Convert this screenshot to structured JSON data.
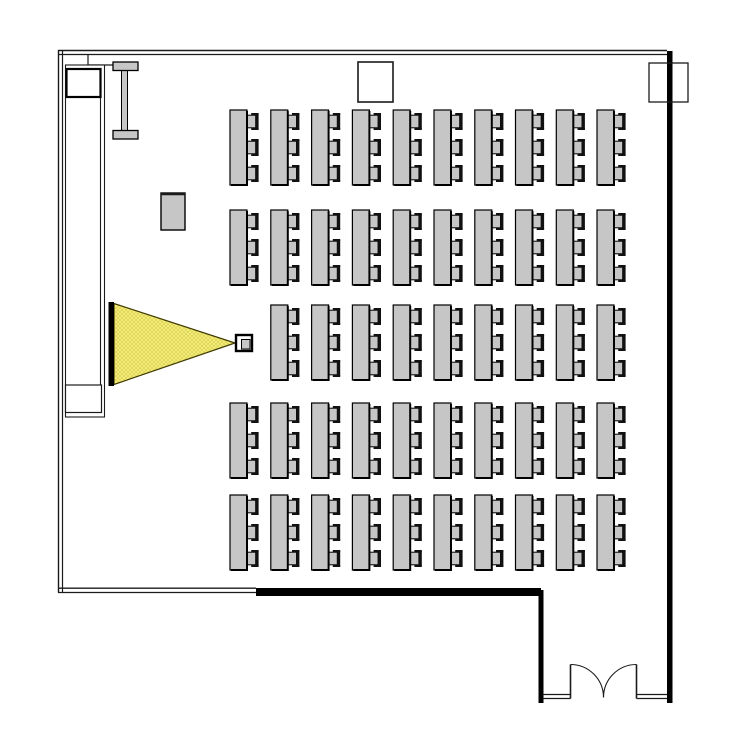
{
  "plan": {
    "canvas": {
      "width": 750,
      "height": 750,
      "background": "#ffffff"
    },
    "colors": {
      "line": "#1b1b1b",
      "wall_thick": "#000000",
      "furniture_fill": "#c6c6c6",
      "furniture_stroke": "#000000",
      "chair_dark": "#111111",
      "white": "#ffffff",
      "beam_fill": "#f8f480",
      "beam_hatch": "#ddd257",
      "beam_stroke": "#3f3a00",
      "screen_fill": "#000000"
    },
    "walls": {
      "top": {
        "y_outer": 50.5,
        "y_inner": 54.5,
        "x_start": 58,
        "x_end": 667
      },
      "top_notch": {
        "points": [
          [
            88,
            54.5
          ],
          [
            88,
            65
          ],
          [
            113,
            65
          ]
        ]
      },
      "left": {
        "x_outer": 58.5,
        "x_inner": 62.5,
        "y_start": 50,
        "y_end": 592.5
      },
      "bottom_thin": {
        "y_outer": 588.2,
        "y_inner": 592.5,
        "x_start": 58,
        "x_end": 256
      },
      "bottom_thick": {
        "x": 256,
        "y": 588,
        "width": 285,
        "height": 8
      },
      "right_thick": {
        "x": 667,
        "y": 51,
        "width": 5.5,
        "height": 652
      },
      "vestibule_left": {
        "x": 538.5,
        "y": 590,
        "width": 5,
        "height": 113
      },
      "vestibule_bottom_left": {
        "y_outer": 694.5,
        "y_inner": 698.5,
        "x_start": 543,
        "x_end": 570.5
      },
      "vestibule_bottom_right": {
        "y_outer": 694.5,
        "y_inner": 698.5,
        "x_start": 636.5,
        "x_end": 667
      }
    },
    "door": {
      "leaf_left_x": 570.5,
      "leaf_right_x": 636.5,
      "leaf_top_y": 664.5,
      "leaf_bottom_y": 698.5,
      "radius": 33,
      "meet_x": 603.5,
      "meet_y": 697.5
    },
    "fixtures": {
      "top_center_box": {
        "x": 358,
        "y": 62,
        "width": 35,
        "height": 40
      },
      "top_right_box": {
        "x": 649,
        "y": 63,
        "width": 39,
        "height": 39
      },
      "partition": {
        "outer": {
          "x": 65.5,
          "y": 65,
          "width": 39,
          "height": 352
        },
        "inner_right_line": {
          "x": 100.5,
          "y_start": 97,
          "y_end": 385
        },
        "top_box": {
          "x": 66.5,
          "y": 69,
          "width": 34,
          "height": 28
        },
        "bottom_box": {
          "x": 65.5,
          "y": 385,
          "width": 36,
          "height": 27.5
        }
      },
      "ibeam_column": {
        "top_flange": {
          "x": 113,
          "y": 62,
          "width": 25,
          "height": 8.5
        },
        "bottom_flange": {
          "x": 113,
          "y": 130.5,
          "width": 25,
          "height": 8.5
        },
        "web": {
          "x": 121.5,
          "y": 70.5,
          "width": 6,
          "height": 60
        }
      },
      "podium": {
        "x": 161,
        "y": 193,
        "width": 24,
        "height": 37
      },
      "projection_screen": {
        "x": 108.5,
        "y": 302,
        "width": 5.5,
        "height": 84
      },
      "projector": {
        "outer": {
          "x": 236,
          "y": 335,
          "width": 16,
          "height": 16
        },
        "inner": {
          "x": 241.5,
          "y": 339.5,
          "width": 8.5,
          "height": 9.5
        }
      },
      "light_beam": {
        "apex": [
          235,
          343
        ],
        "base_top": [
          114,
          303.5
        ],
        "base_bottom": [
          114,
          384.5
        ]
      }
    },
    "desks": {
      "rows_y": [
        110,
        210,
        305,
        403,
        495
      ],
      "cols_x": [
        230,
        270.8,
        311.6,
        352.4,
        393.2,
        434,
        474.8,
        515.5,
        556.3,
        597
      ],
      "table": {
        "width": 17,
        "height": 75
      },
      "chair": {
        "width": 12,
        "height": 17,
        "offsets_y": [
          3,
          29,
          55
        ]
      },
      "skip_cells": [
        [
          2,
          0
        ]
      ]
    }
  }
}
